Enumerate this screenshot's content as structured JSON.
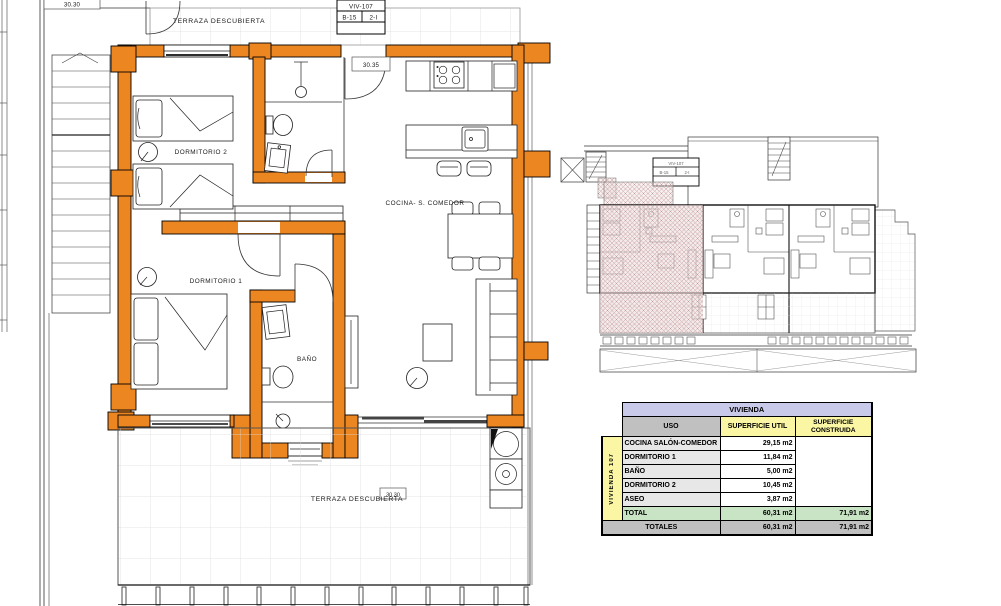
{
  "plan": {
    "terrace_top_label": "TERRAZA DESCUBIERTA",
    "terrace_bottom_label": "TERRAZA DESCUBIERTA",
    "room_dormitorio2": "DORMITORIO 2",
    "room_dormitorio1": "DORMITORIO 1",
    "room_bano": "BAÑO",
    "room_cocina": "COCINA- S. COMEDOR",
    "dim_top_left": "30.30",
    "dim_entrance": "30.35",
    "dim_terrace": "30.30",
    "unit_box": {
      "unit": "VIV-107",
      "block": "B-15",
      "type": "2-I"
    }
  },
  "site_plan": {
    "unit_box": {
      "unit": "VIV-107",
      "block": "B-15",
      "type": "2-I"
    }
  },
  "table": {
    "title": "VIVIENDA",
    "col_uso": "USO",
    "col_util": "SUPERFICIE UTIL",
    "col_construida": "SUPERFICIE CONSTRUIDA",
    "side_label": "VIVIENDA 107",
    "rows": [
      {
        "uso": "COCINA SALÓN-COMEDOR",
        "util": "29,15 m2"
      },
      {
        "uso": "DORMITORIO 1",
        "util": "11,84 m2"
      },
      {
        "uso": "BAÑO",
        "util": "5,00 m2"
      },
      {
        "uso": "DORMITORIO 2",
        "util": "10,45 m2"
      },
      {
        "uso": "ASEO",
        "util": "3,87 m2"
      }
    ],
    "total": {
      "label": "TOTAL",
      "util": "60,31 m2",
      "construida": "71,91 m2"
    },
    "totales": {
      "label": "TOTALES",
      "util": "60,31 m2",
      "construida": "71,91 m2"
    }
  },
  "colors": {
    "wall-orange": "#EC8620",
    "table-title-bg": "#C9C9EA",
    "table-header-gray": "#C0C0C0",
    "table-yellow": "#FAF6A4",
    "table-row-gray": "#E7E7E7",
    "table-total-green": "#C9E3C5",
    "hatch-pink": "#C59898",
    "hatch-base": "#E9DADA"
  }
}
